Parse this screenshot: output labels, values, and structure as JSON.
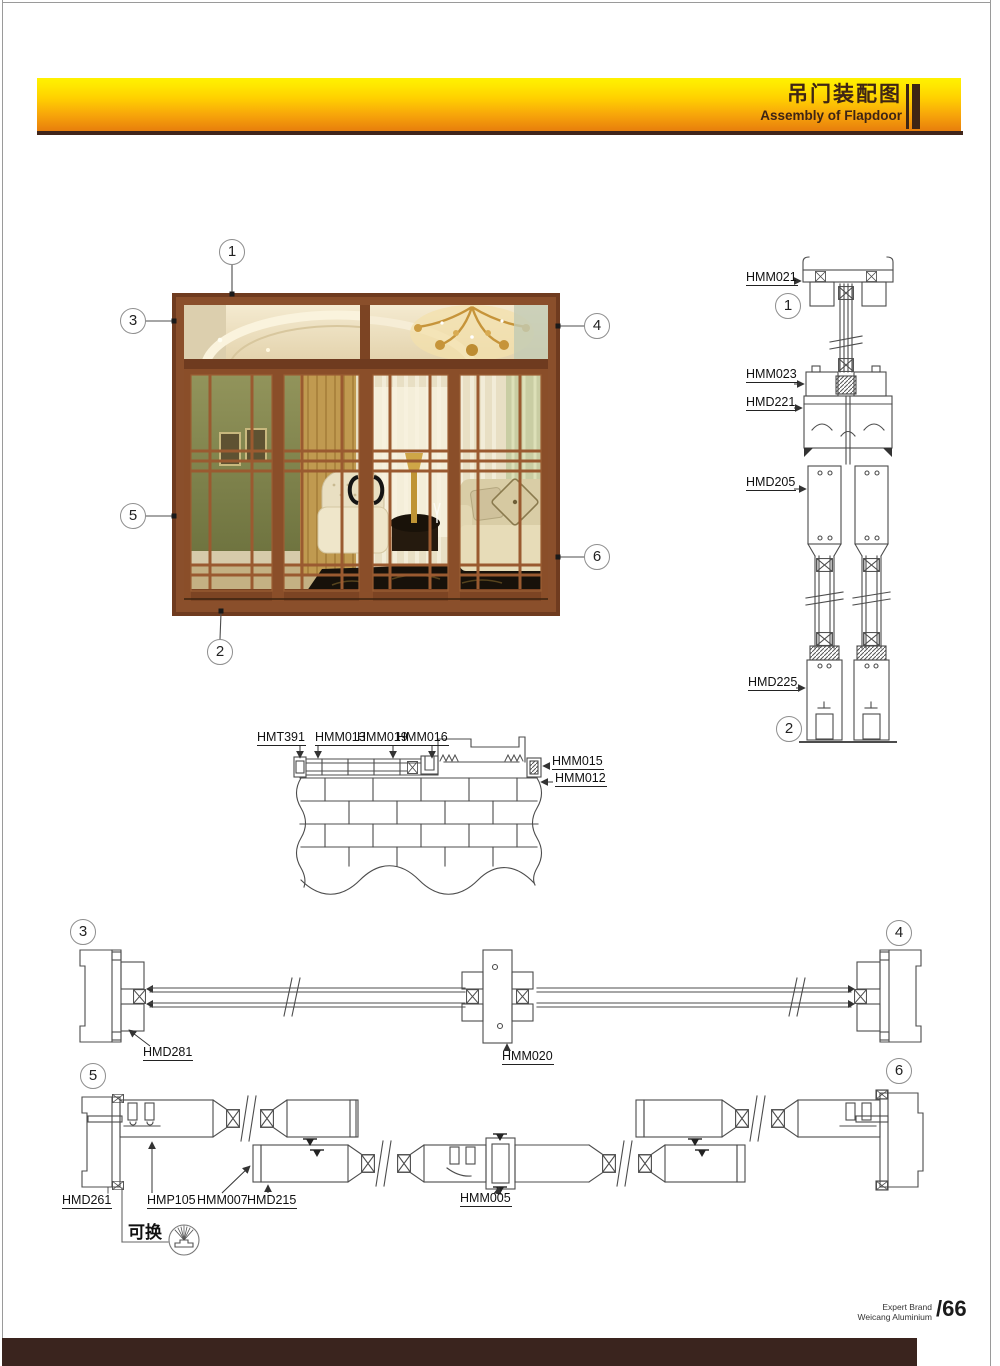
{
  "header": {
    "title_cn": "吊门装配图",
    "title_en": "Assembly of Flapdoor"
  },
  "photo_callouts": [
    "1",
    "2",
    "3",
    "4",
    "5",
    "6"
  ],
  "vertical_section": {
    "callouts": [
      "1",
      "2"
    ],
    "labels": [
      "HMM021",
      "HMM023",
      "HMD221",
      "HMD205",
      "HMD225"
    ]
  },
  "wall_section": {
    "labels_top": [
      "HMT391",
      "HMM013",
      "HMM019",
      "HMM016"
    ],
    "labels_right": [
      "HMM015",
      "HMM012"
    ]
  },
  "transom_section": {
    "callouts": [
      "3",
      "4"
    ],
    "labels": [
      "HMD281",
      "HMM020"
    ]
  },
  "panel_section": {
    "callouts": [
      "5",
      "6"
    ],
    "labels": [
      "HMD261",
      "HMP105",
      "HMM007",
      "HMD215",
      "HMM005"
    ],
    "note": "可换"
  },
  "footer": {
    "brand_line1": "Expert Brand",
    "brand_line2": "Weicang Aluminium",
    "page_number": "/66"
  },
  "colors": {
    "banner_top": "#fff200",
    "banner_bottom": "#e87e0c",
    "accent_dark_brown": "#3e2514",
    "footer_bar": "#3a241e",
    "drawing_line": "#4c4c4c"
  }
}
